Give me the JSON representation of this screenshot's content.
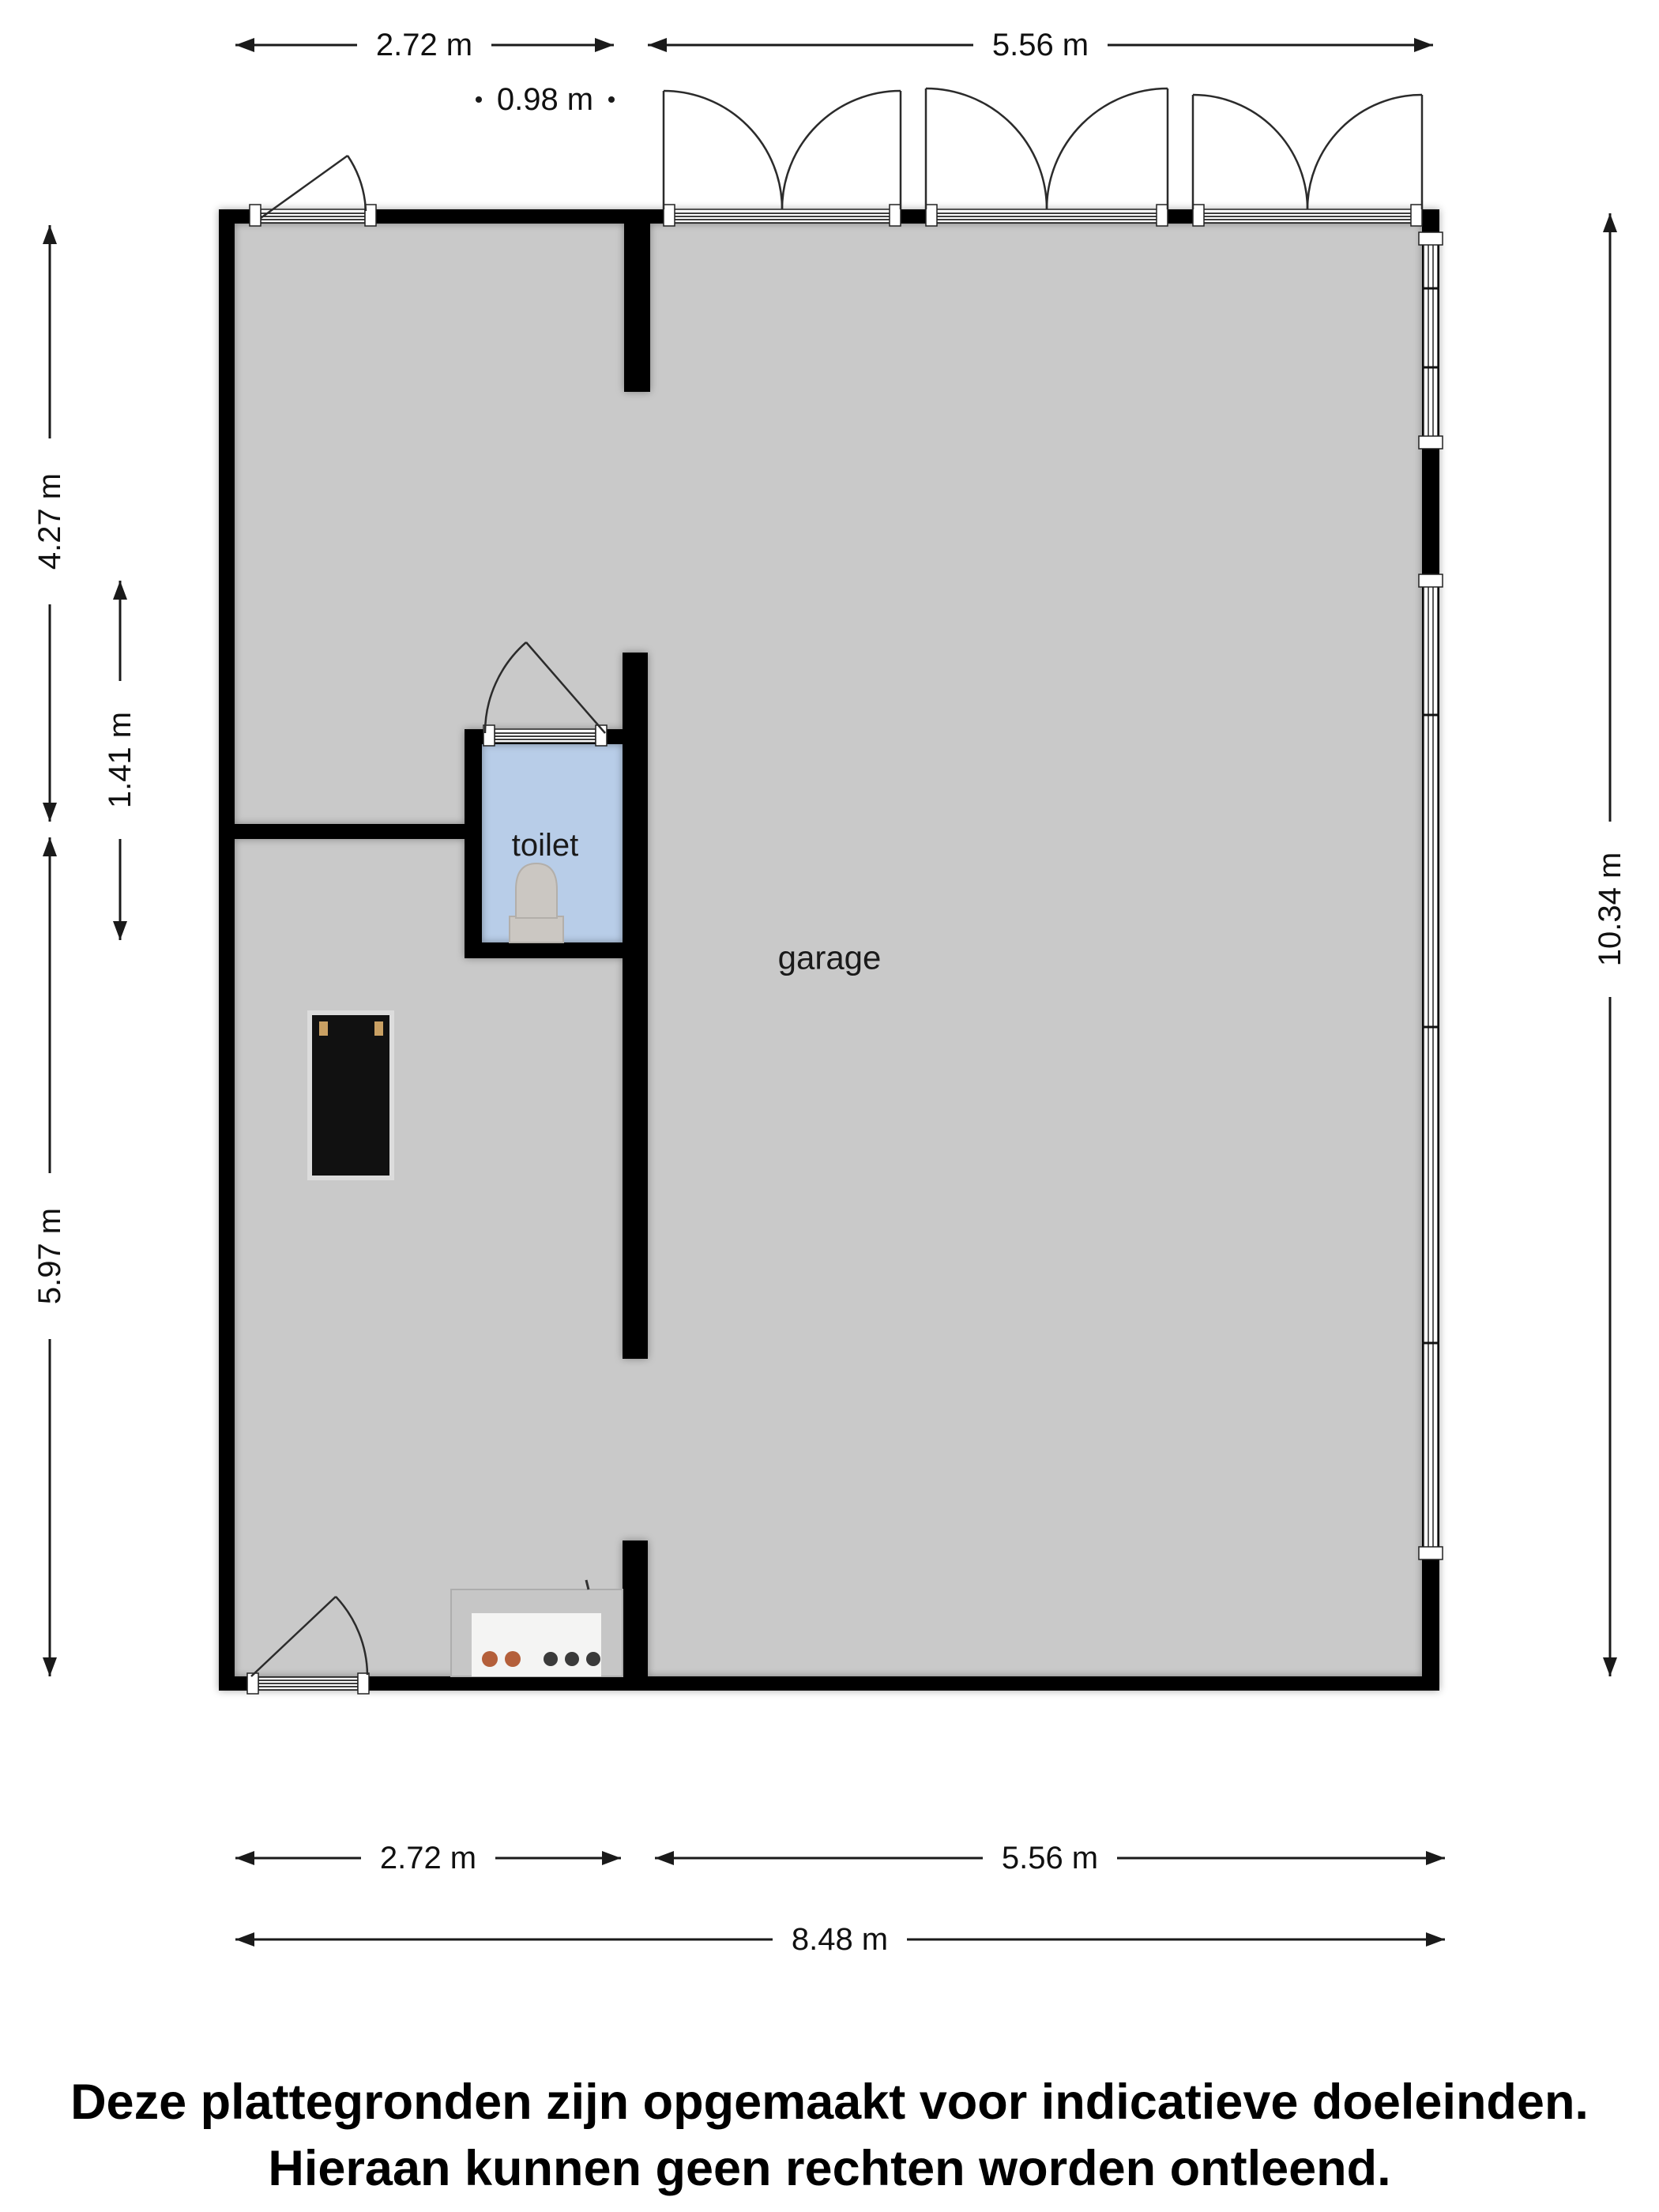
{
  "page": {
    "background": "#ffffff",
    "type": "floor-plan"
  },
  "rooms": {
    "garage_label": "garage",
    "toilet_label": "toilet"
  },
  "dimensions": {
    "top_width_left": "2.72 m",
    "top_width_right": "5.56 m",
    "top_door_width": "0.98 m",
    "left_height_upper": "4.27 m",
    "left_height_toilet": "1.41 m",
    "left_height_lower": "5.97 m",
    "right_height_total": "10.34 m",
    "bottom_width_left": "2.72 m",
    "bottom_width_right": "5.56 m",
    "bottom_width_total": "8.48 m"
  },
  "disclaimer": {
    "line1": "Deze plattegronden zijn opgemaakt voor indicatieve doeleinden.",
    "line2": "Hieraan kunnen geen rechten worden ontleend."
  },
  "colors": {
    "wall": "#000000",
    "floor": "#c9c9c9",
    "toilet_floor": "#b8cde8",
    "dimension_line": "#1a1a1a",
    "door_arc": "#2b2b2b",
    "toilet_fixture": "#cbc7c2",
    "appliance_frame": "#c6c6c6",
    "appliance_panel": "#f4f4f3",
    "knob_orange": "#b45f3a",
    "knob_dark": "#3a3a3a",
    "cabinet_fill": "#111111",
    "cabinet_handle": "#c9a063"
  }
}
